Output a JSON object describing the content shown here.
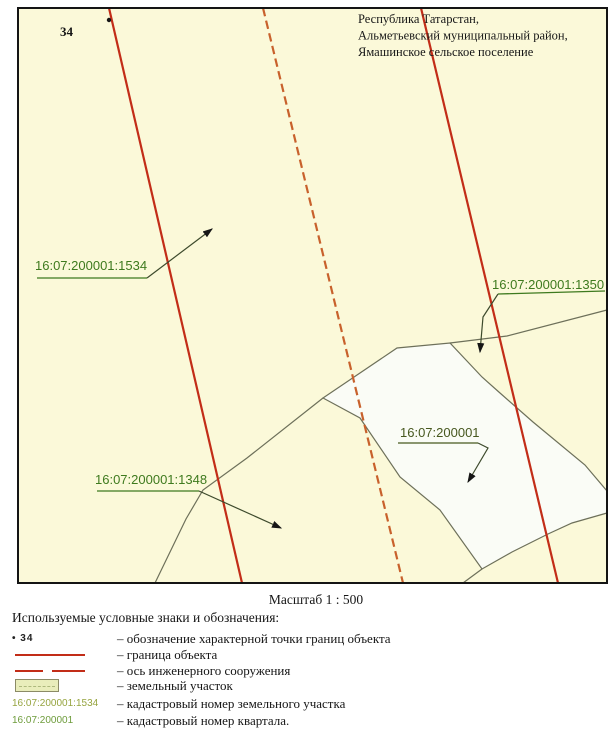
{
  "colors": {
    "map_bg": "#fbf9d9",
    "boundary_red": "#c22d18",
    "axis_orange": "#c8612c",
    "quarter_line": "#6d705a",
    "parcel_white": "#fafcf6",
    "label_green": "#3e7a1e",
    "quarter_label_green": "#47581f",
    "leader": "#3d4a2c",
    "ink": "#161616"
  },
  "header": {
    "line1": "Республика Татарстан,",
    "line2": "Альметьевский муниципальный район,",
    "line3": "Ямашинское сельское поселение"
  },
  "map": {
    "frame": {
      "x": 18,
      "y": 8,
      "w": 589,
      "h": 575
    },
    "point34": {
      "label": "34",
      "dot": [
        109,
        20
      ],
      "label_pos": [
        60,
        36
      ]
    },
    "parcel_polygon": "323,398 397,348 450,343 482,377 500,393 533,422 585,465 607,491 607,513 572,523 548,534 512,552 482,569 440,510 400,477 360,418",
    "quarter_lines": [
      "450,343 507,336 607,310",
      "323,398 247,458 203,490 186,519 155,583",
      "482,569 463,583"
    ],
    "boundary_lines": [
      "109,8 242,583",
      "421,8 558,583"
    ],
    "axis_line": "263,8 403,583",
    "labels": [
      {
        "id": "parcel-1534",
        "text": "16:07:200001:1534",
        "tx": 35,
        "ty": 270,
        "underline": "37,278 147,278",
        "leader": "147,278 212,229",
        "color_key": "label_green"
      },
      {
        "id": "parcel-1350",
        "text": "16:07:200001:1350",
        "tx": 492,
        "ty": 289,
        "underline": "498,294 605,291",
        "leader": "498,294 483,317 480,352",
        "color_key": "label_green"
      },
      {
        "id": "parcel-1348",
        "text": "16:07:200001:1348",
        "tx": 95,
        "ty": 484,
        "underline": "97,491 199,491",
        "leader": "199,491 281,528",
        "color_key": "label_green"
      },
      {
        "id": "quarter",
        "text": "16:07:200001",
        "tx": 400,
        "ty": 437,
        "underline": "398,443 478,443",
        "leader": "478,443 488,448 468,482",
        "color_key": "quarter_label_green"
      }
    ]
  },
  "scale": {
    "text": "Масштаб 1 : 500"
  },
  "legend": {
    "title": "Используемые условные знаки и обозначения:",
    "rows": [
      {
        "symbol": "point",
        "symbol_text": "• 34",
        "desc": "– обозначение характерной точки границ объекта"
      },
      {
        "symbol": "solid-line",
        "symbol_text": "",
        "desc": "– граница объекта"
      },
      {
        "symbol": "dashed-line",
        "symbol_text": "",
        "desc": "– ось инженерного сооружения"
      },
      {
        "symbol": "parcel-rect",
        "symbol_text": "",
        "desc": "– земельный участок"
      },
      {
        "symbol": "text-parcel",
        "symbol_text": "16:07:200001:1534",
        "desc": "– кадастровый номер земельного участка"
      },
      {
        "symbol": "text-quarter",
        "symbol_text": "16:07:200001",
        "desc": "– кадастровый номер квартала."
      }
    ]
  }
}
